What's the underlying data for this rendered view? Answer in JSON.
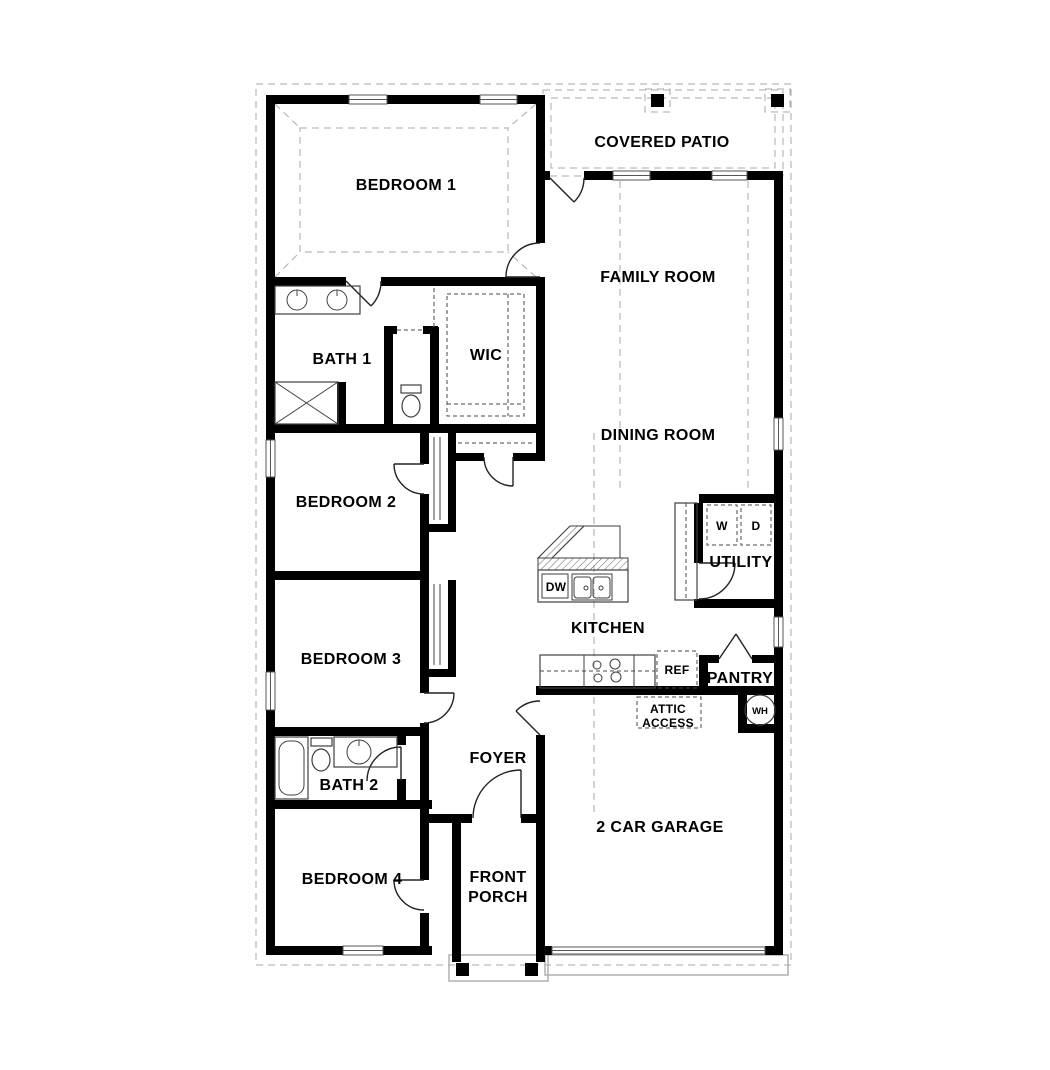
{
  "rooms": {
    "bedroom1": {
      "label": "BEDROOM 1"
    },
    "covered_patio": {
      "label": "COVERED PATIO"
    },
    "family_room": {
      "label": "FAMILY ROOM"
    },
    "bath1": {
      "label": "BATH 1"
    },
    "wic": {
      "label": "WIC"
    },
    "dining_room": {
      "label": "DINING ROOM"
    },
    "bedroom2": {
      "label": "BEDROOM 2"
    },
    "utility": {
      "label": "UTILITY"
    },
    "kitchen": {
      "label": "KITCHEN"
    },
    "bedroom3": {
      "label": "BEDROOM 3"
    },
    "pantry": {
      "label": "PANTRY"
    },
    "bath2": {
      "label": "BATH 2"
    },
    "foyer": {
      "label": "FOYER"
    },
    "bedroom4": {
      "label": "BEDROOM 4"
    },
    "garage": {
      "label": "2 CAR GARAGE"
    },
    "front_porch": {
      "lines": [
        "FRONT",
        "PORCH"
      ]
    },
    "attic_access": {
      "lines": [
        "ATTIC",
        "ACCESS"
      ]
    }
  },
  "appliances": {
    "washer": "W",
    "dryer": "D",
    "dishwasher": "DW",
    "refrigerator": "REF",
    "water_heater": "WH"
  },
  "colors": {
    "wall": "#000000",
    "fixture": "#3f3f3f",
    "light": "#aaaaaa",
    "text": "#000000",
    "background": "#ffffff"
  }
}
